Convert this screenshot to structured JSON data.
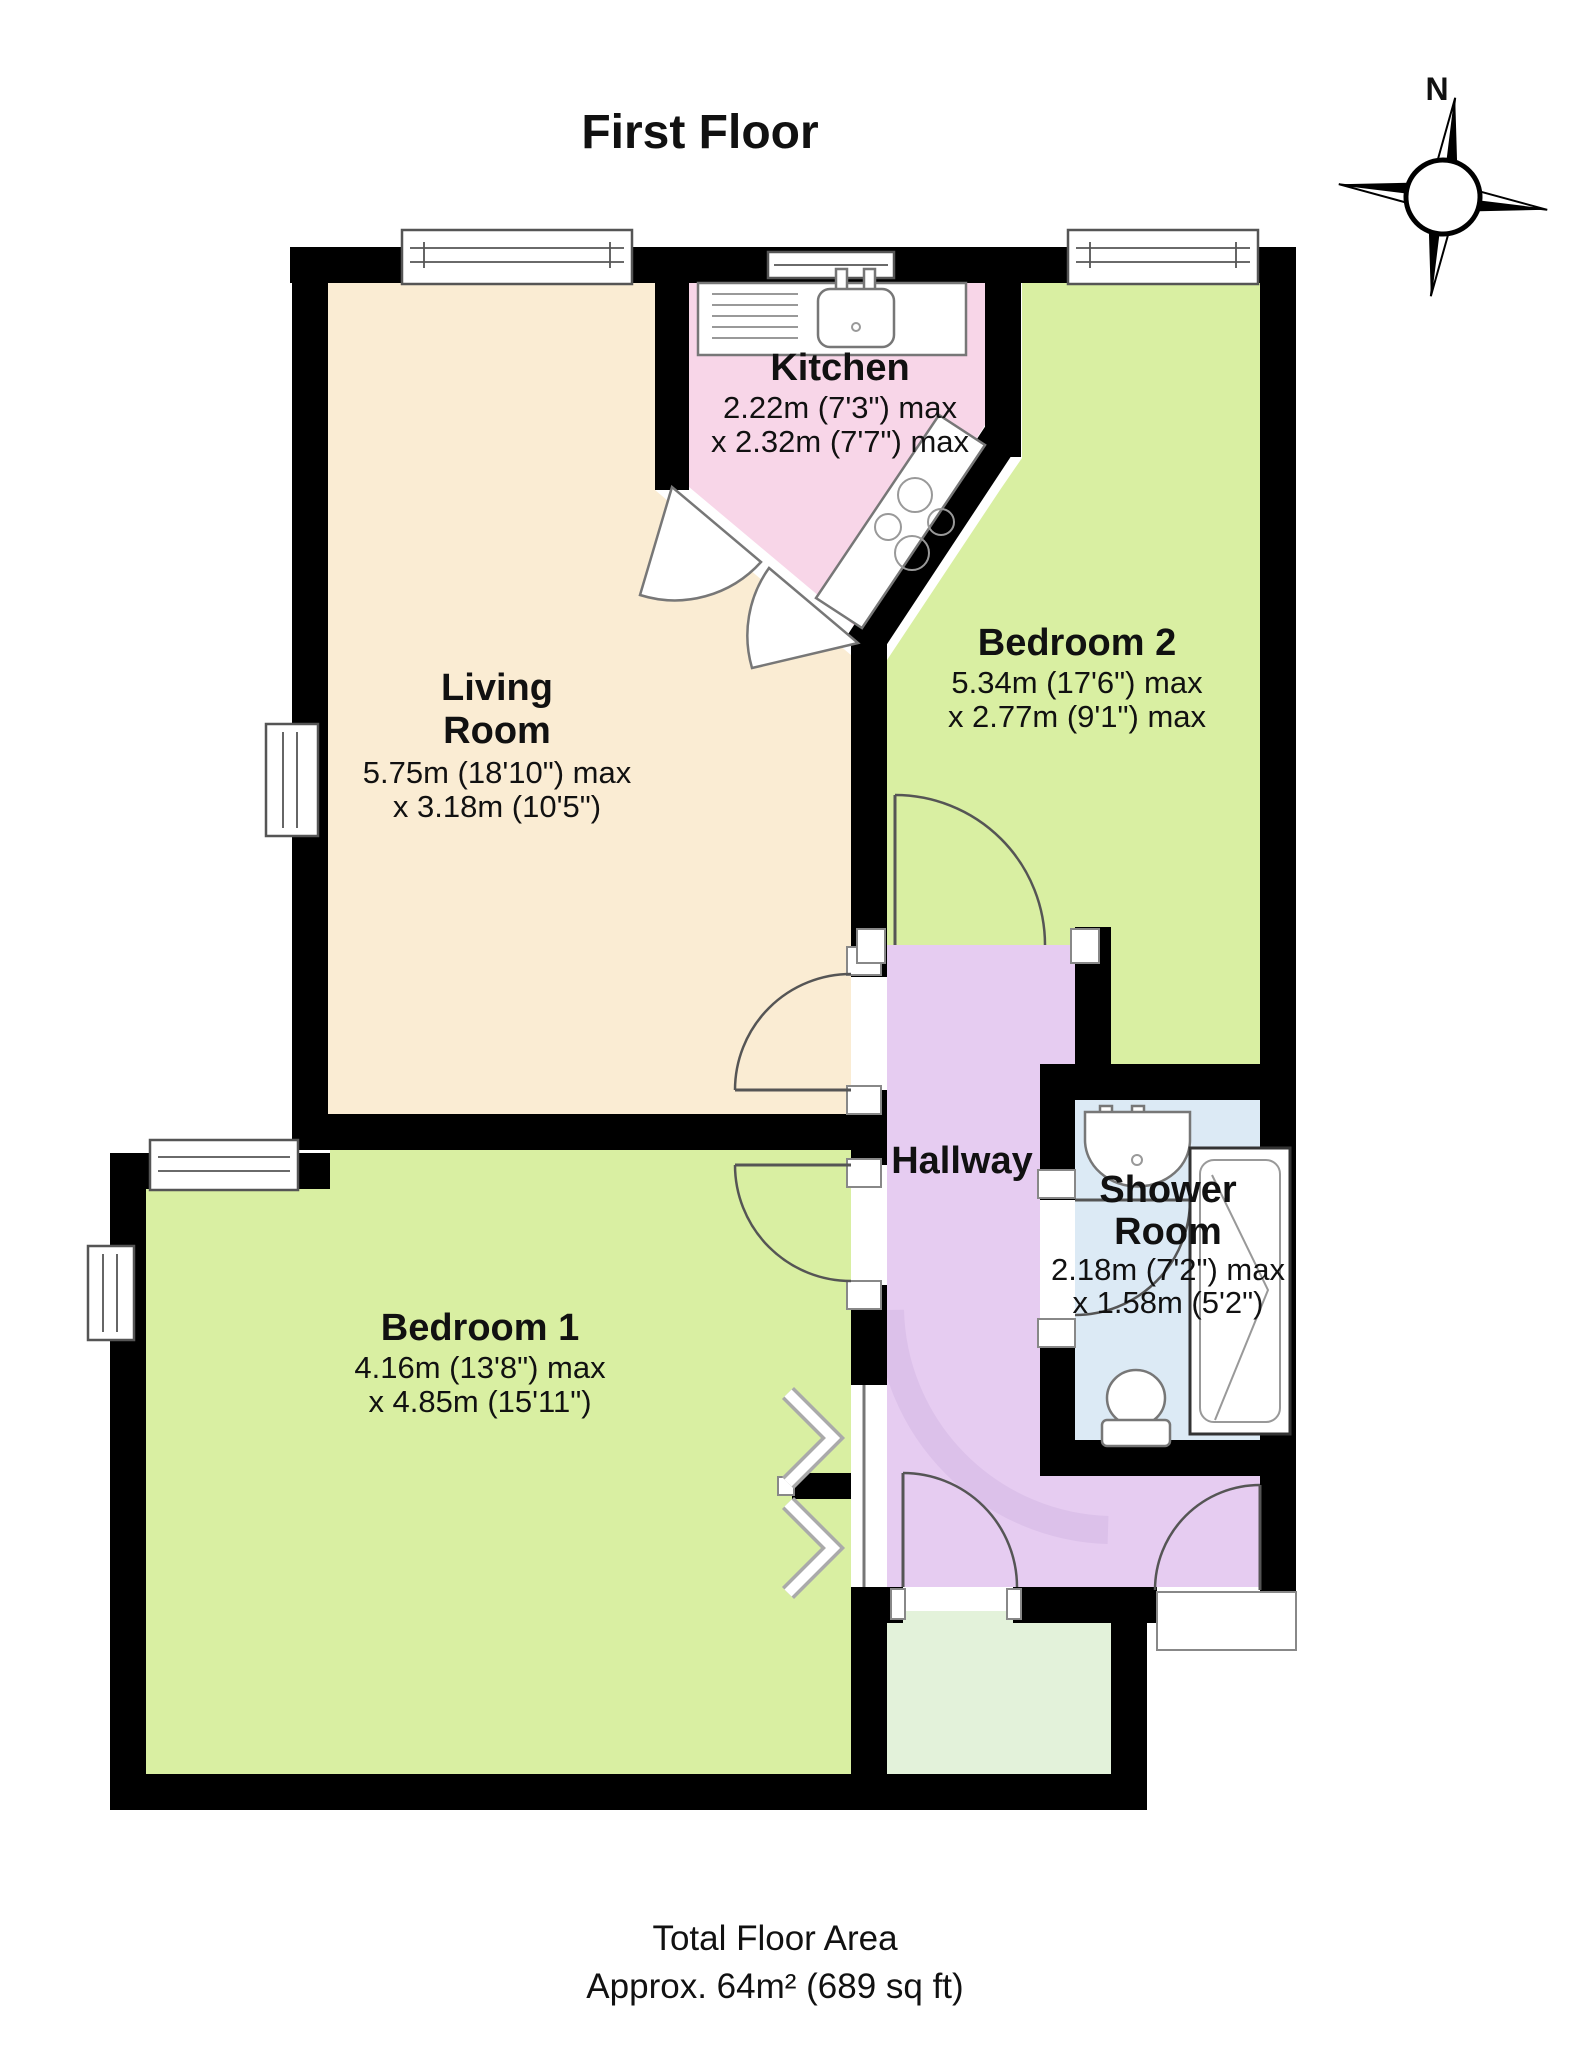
{
  "title": "First Floor",
  "compass": {
    "north_label": "N"
  },
  "rooms": [
    {
      "id": "living-room",
      "name": "Living Room",
      "name_lines": [
        "Living",
        "Room"
      ],
      "dim_line1": "5.75m (18'10\") max",
      "dim_line2": "x 3.18m (10'5\")",
      "color": "#faecd3"
    },
    {
      "id": "kitchen",
      "name": "Kitchen",
      "dim_line1": "2.22m (7'3\") max",
      "dim_line2": "x 2.32m (7'7\") max",
      "color": "#f8d6e8"
    },
    {
      "id": "bedroom-2",
      "name": "Bedroom 2",
      "dim_line1": "5.34m (17'6\") max",
      "dim_line2": "x 2.77m (9'1\") max",
      "color": "#d9efa2"
    },
    {
      "id": "bedroom-1",
      "name": "Bedroom 1",
      "dim_line1": "4.16m (13'8\") max",
      "dim_line2": "x 4.85m (15'11\")",
      "color": "#d9efa2"
    },
    {
      "id": "hallway",
      "name": "Hallway",
      "color": "#e6ccf1"
    },
    {
      "id": "shower-room",
      "name": "Shower Room",
      "name_lines": [
        "Shower",
        "Room"
      ],
      "dim_line1": "2.18m (7'2\") max",
      "dim_line2": "x 1.58m (5'2\")",
      "color": "#dceaf5"
    },
    {
      "id": "landing",
      "name": "",
      "color": "#e3f2da"
    }
  ],
  "footer": {
    "line1": "Total Floor Area",
    "line2": "Approx. 64m² (689 sq ft)"
  },
  "colors": {
    "wall": "#000000",
    "window_frame": "#555555",
    "door_arc": "#555555",
    "shadow_arc": "#d2b5e3"
  }
}
